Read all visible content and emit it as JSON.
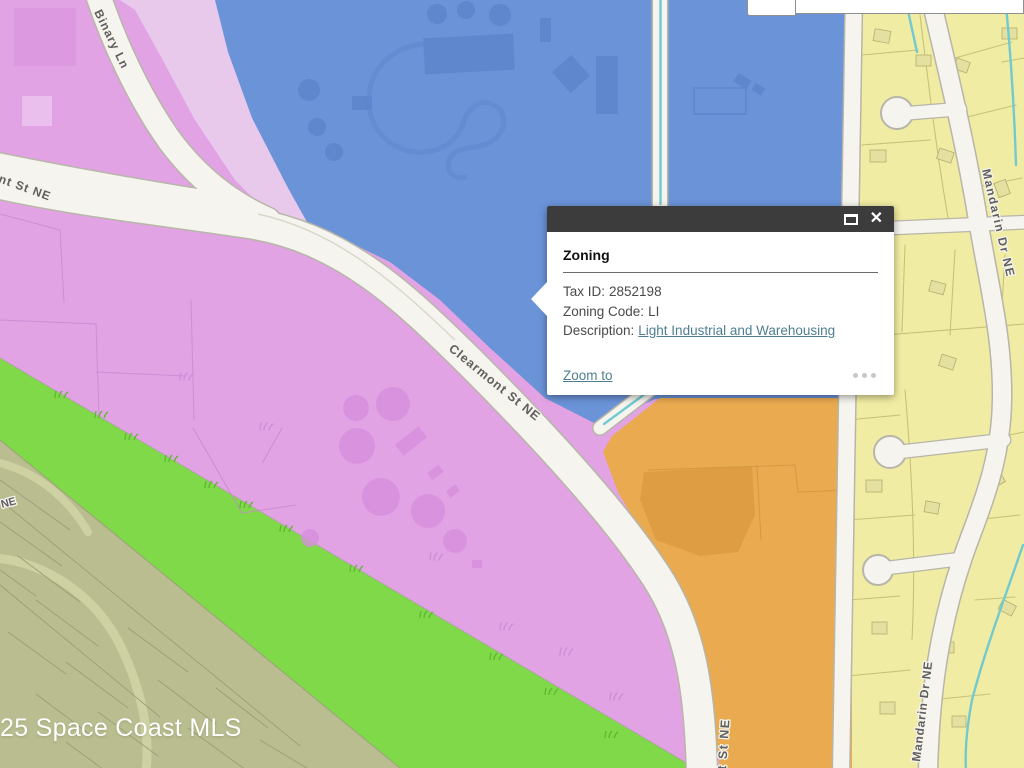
{
  "colors": {
    "zone_pink": "#e2a3e5",
    "zone_pink_dark": "#d78fdc",
    "zone_pink_line": "#c987d0",
    "zone_lavender": "#e8c9ec",
    "zone_blue": "#6a93d8",
    "zone_blue_dark": "#5c85cd",
    "zone_yellow": "#f0eca3",
    "zone_yellow_line": "#c3be73",
    "house_fill": "#e4e09f",
    "house_stroke": "#b4af6e",
    "zone_orange": "#e9aa50",
    "zone_orange_dark": "#dd9b41",
    "zone_orange_line": "#cf9340",
    "zone_green": "#7fd948",
    "zone_green_dark": "#5cb930",
    "zone_olive": "#b9bd8f",
    "zone_olive_line": "#99a077",
    "zone_olive_street": "#ced2a3",
    "road_fill": "#f6f4ee",
    "road_casing": "#b8b5a9",
    "road_seam": "#dbd8cb",
    "canal": "#72cad0",
    "label_text": "#5f5f5f",
    "label_halo": "#f5f3ec",
    "popup_header": "#3c3c3c",
    "popup_text": "#4a4a4a",
    "link": "#4f7e91",
    "divider": "#6b6b6b",
    "dots": "#c7c7c7",
    "watermark": "#ffffff",
    "toolbar_bg": "#ffffff",
    "toolbar_border": "#8f8f8f"
  },
  "map": {
    "watermark": "25 Space Coast MLS",
    "road_labels": [
      {
        "text": "Binary Ln"
      },
      {
        "text": "nt St NE"
      },
      {
        "text": "Clearmont St NE"
      },
      {
        "text": "t St NE"
      },
      {
        "text": "Mandarin Dr NE"
      },
      {
        "text": "Mandarin Dr NE"
      },
      {
        "text": "NE"
      }
    ]
  },
  "popup": {
    "title": "Zoning",
    "fields": [
      {
        "label": "Tax ID:",
        "value": "2852198"
      },
      {
        "label": "Zoning Code:",
        "value": "LI"
      },
      {
        "label": "Description:",
        "link": "Light Industrial and Warehousing"
      }
    ],
    "zoom_to_label": "Zoom to",
    "close_icon": "✕"
  }
}
